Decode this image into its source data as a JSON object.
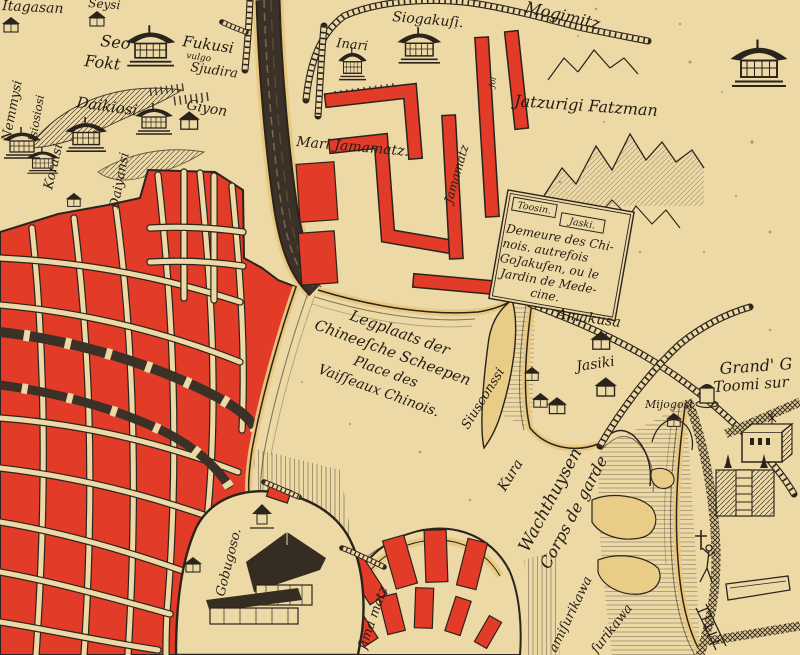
{
  "palette": {
    "parchment": "#ecd9a6",
    "block_red": "#e23b28",
    "ink": "#2b241c",
    "sand": "#e9c87f",
    "river_dark": "#3b3127"
  },
  "labels": {
    "itagasan": "Itagasan",
    "seysi": "Seysi",
    "seo": "Seo",
    "fokt": "Fokt",
    "fukusi": "Fukusi",
    "fukusi_vulgo": "vulgo",
    "fukusi_sjudira": "Sjudira",
    "daikiosi": "Daikiosi",
    "giyon": "Giyon",
    "nemmysi": "Nemmysi",
    "isiosiosi": "Isiosiosi",
    "koraisi": "Koraisi",
    "daiyansi": "Daiyansi",
    "inari": "Inari",
    "siogakusi": "Siogakuſi.",
    "mogimitz": "Mogimitz",
    "jatzurigi_fatzman": "Jatzurigi Fatzman",
    "mari_jamamatz": "Mari Jamamatz.",
    "jamamatz": "Jamamatz",
    "jol": "Jol",
    "toosin": "Toosin.",
    "jaski": "Jaski.",
    "demeure_1": "Demeure des Chi-",
    "demeure_2": "nois. autrefois",
    "demeure_3": "GoJakuſen, ou le",
    "demeure_4": "Jardin de Mede-",
    "demeure_5": "cine.",
    "amakusa": "Amakusa",
    "jasiki": "Jasiki",
    "mijogosi": "Mijogosi",
    "legplaats_1": "Legplaats der",
    "legplaats_2": "Chineeſche Scheepen",
    "legplaats_3": "Place des",
    "legplaats_4": "Vaiſſeaux Chinois.",
    "siusconssi": "Siusconssi",
    "kura": "Kura",
    "wachthuysen": "Wachthuysen",
    "corps_de_garde": "Corps de garde",
    "grand_g": "Grand' G",
    "toomi_sur": "Toomi sur",
    "gobugoso": "Gobugoso.",
    "desima_matz": "ſima matz",
    "amisurikawa": "amiſurikawa",
    "surikawa": "ſurikawa"
  }
}
